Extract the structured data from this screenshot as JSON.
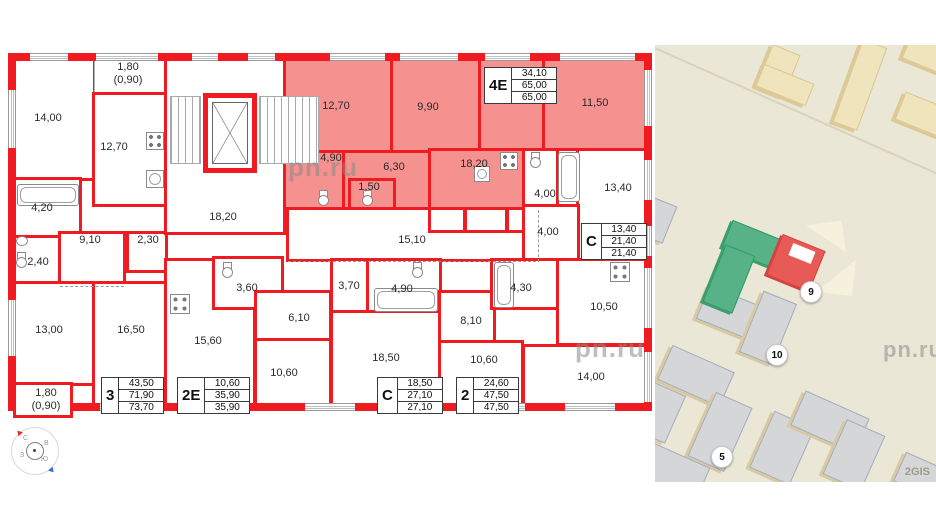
{
  "watermark": "pn.ru",
  "plan": {
    "room_labels": [
      "14,00",
      "1,80",
      "(0,90)",
      "12,70",
      "4,20",
      "2,40",
      "9,10",
      "2,30",
      "13,00",
      "16,50",
      "1,80",
      "(0,90)",
      "18,20",
      "12,70",
      "9,90",
      "11,50",
      "4,90",
      "6,30",
      "1,50",
      "18,20",
      "15,10",
      "3,60",
      "6,10",
      "15,60",
      "10,60",
      "3,70",
      "4,90",
      "8,10",
      "18,50",
      "10,60",
      "4,30",
      "10,50",
      "14,00",
      "4,00",
      "4,00",
      "13,40"
    ],
    "info_boxes": [
      {
        "id": "4Е",
        "values": [
          "34,10",
          "65,00",
          "65,00"
        ]
      },
      {
        "id": "3",
        "values": [
          "43,50",
          "71,90",
          "73,70"
        ]
      },
      {
        "id": "2Е",
        "values": [
          "10,60",
          "35,90",
          "35,90"
        ]
      },
      {
        "id": "С",
        "values": [
          "18,50",
          "27,10",
          "27,10"
        ]
      },
      {
        "id": "2",
        "values": [
          "24,60",
          "47,50",
          "47,50"
        ]
      },
      {
        "id": "С",
        "values": [
          "13,40",
          "21,40",
          "21,40"
        ]
      }
    ],
    "compass": {
      "n": "С",
      "e": "В",
      "s": "Ю",
      "w": "З"
    }
  },
  "map": {
    "markers": [
      "9",
      "10",
      "5"
    ],
    "credit": "2GIS"
  },
  "colors": {
    "wall_red": "#ef1b20",
    "highlight_pink": "#f5918e",
    "map_building_green": "#57b287",
    "map_building_red": "#e85a55",
    "map_background": "#ebe7d6"
  }
}
